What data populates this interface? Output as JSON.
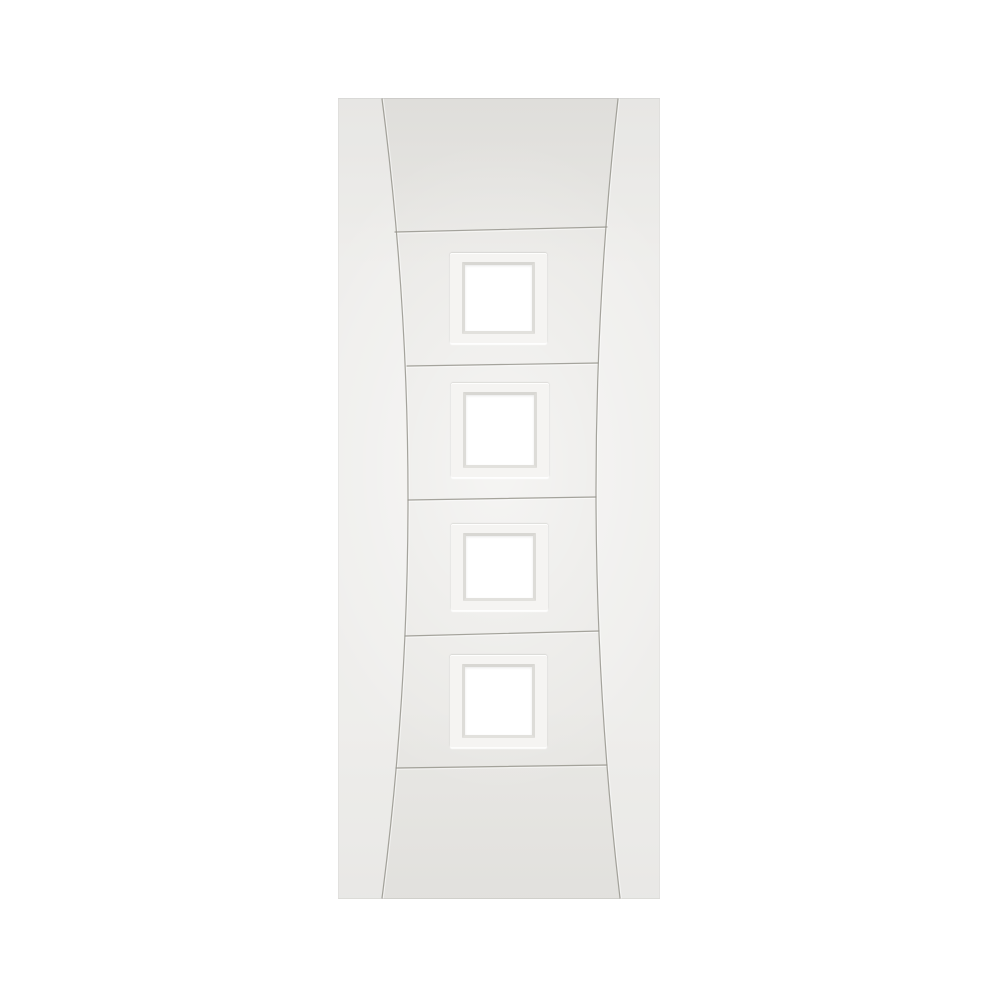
{
  "image": {
    "kind": "product-photo",
    "description": "White primed interior door with two curved vertical grooves, five horizontal panel grooves and four square glazed lites, on a plain white background",
    "lite_count": 4,
    "horizontal_groove_count": 5,
    "curved_groove_count": 2
  },
  "palette": {
    "background": "#ffffff",
    "door_face": "#e9e8e5",
    "groove_line": "#96958d",
    "lite_surround": "#f5f4f2",
    "glazing_bead": "#d8d7d3",
    "glass": "#ffffff"
  }
}
